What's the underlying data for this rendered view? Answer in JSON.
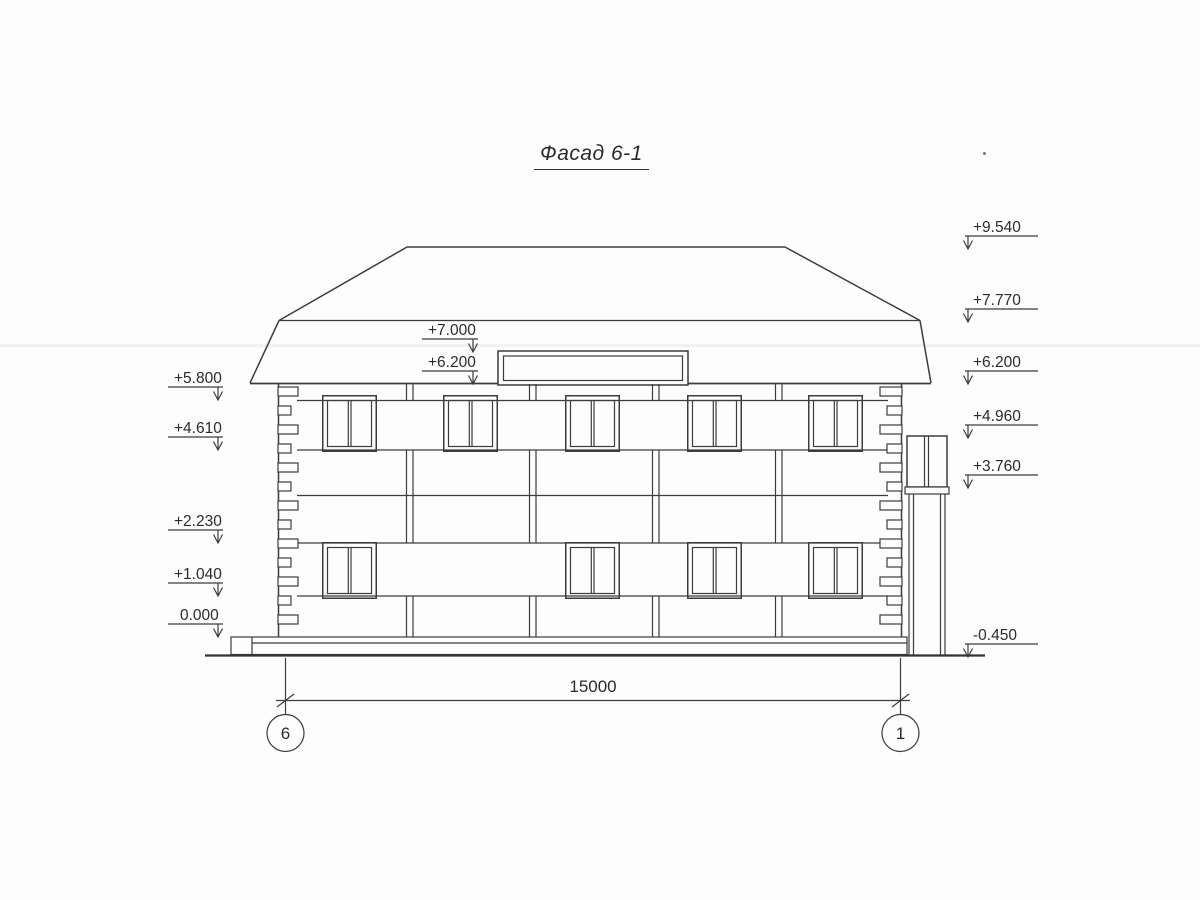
{
  "title": "Фасад 6-1",
  "dimension": {
    "value": "15000"
  },
  "axes": {
    "left": "6",
    "right": "1"
  },
  "elevation_marks": {
    "left": [
      {
        "value": "+5.800"
      },
      {
        "value": "+4.610"
      },
      {
        "value": "+2.230"
      },
      {
        "value": "+1.040"
      },
      {
        "value": "0.000"
      }
    ],
    "middle": [
      {
        "value": "+7.000"
      },
      {
        "value": "+6.200"
      }
    ],
    "right": [
      {
        "value": "+9.540"
      },
      {
        "value": "+7.770"
      },
      {
        "value": "+6.200"
      },
      {
        "value": "+4.960"
      },
      {
        "value": "+3.760"
      },
      {
        "value": "-0.450"
      }
    ]
  },
  "colors": {
    "line": "#3c3c3c",
    "background": "#fdfdfd"
  }
}
